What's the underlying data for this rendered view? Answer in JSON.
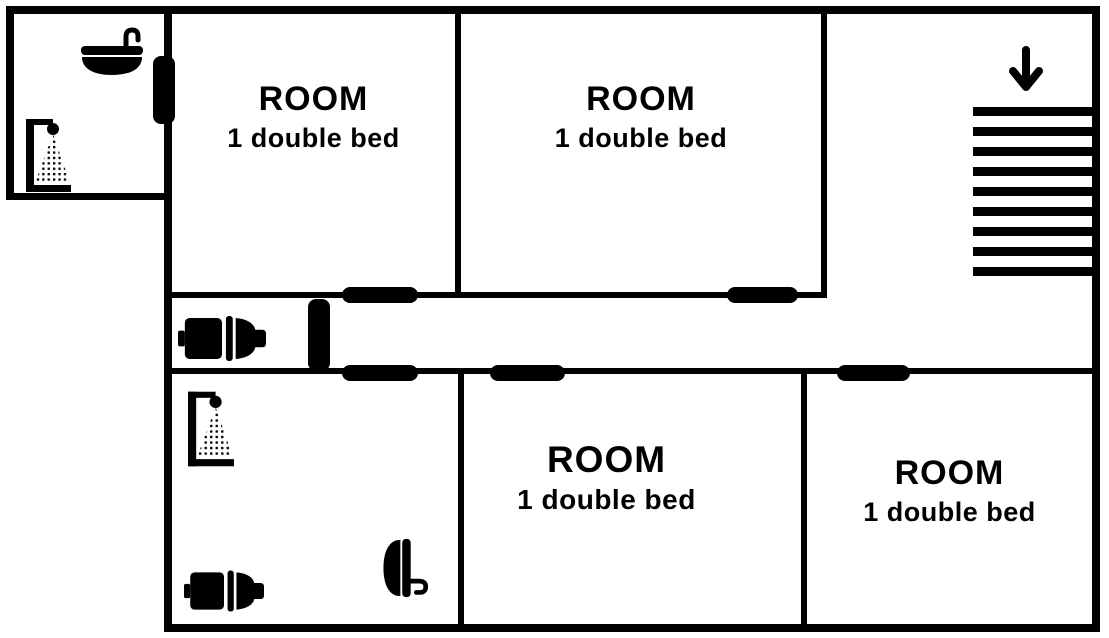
{
  "rooms": [
    {
      "id": "room-top-left",
      "title": "ROOM",
      "subtitle": "1 double bed"
    },
    {
      "id": "room-top-right",
      "title": "ROOM",
      "subtitle": "1 double bed"
    },
    {
      "id": "room-bottom-middle",
      "title": "ROOM",
      "subtitle": "1 double bed"
    },
    {
      "id": "room-bottom-right",
      "title": "ROOM",
      "subtitle": "1 double bed"
    }
  ],
  "bathrooms": {
    "top_left": {
      "fixtures": [
        "sink",
        "shower"
      ]
    },
    "wc_middle_left": {
      "fixtures": [
        "toilet"
      ]
    },
    "bottom_left": {
      "fixtures": [
        "shower",
        "toilet",
        "sink"
      ]
    }
  },
  "stairs": {
    "direction": "down",
    "steps": 9
  },
  "doors": [
    "bathroom-top-left",
    "room-top-left",
    "room-top-right",
    "wc",
    "bathroom-bottom-left",
    "room-bottom-middle",
    "room-bottom-right"
  ],
  "colors": {
    "wall": "#000000",
    "background": "#ffffff"
  }
}
